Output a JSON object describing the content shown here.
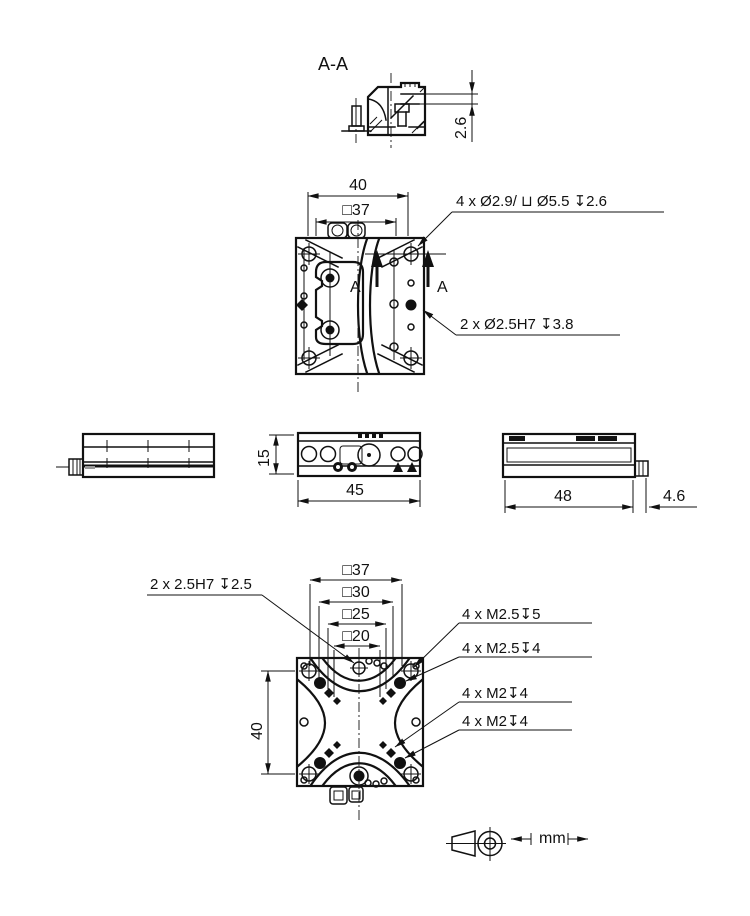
{
  "colors": {
    "ink": "#111111",
    "background": "#ffffff"
  },
  "drawing": {
    "section": {
      "title": "A-A",
      "depth_dim": "2.6"
    },
    "top_view": {
      "width_dim": "40",
      "square_dim": "□37",
      "counterbore_note": "4 x Ø2.9/ ⊔ Ø5.5 ↧2.6",
      "dowel_note": "2 x Ø2.5H7 ↧3.8",
      "cut_label": "A"
    },
    "front_view": {
      "height_dim": "15",
      "width_dim": "45"
    },
    "side_view": {
      "width_dim": "48",
      "connector_dim": "4.6"
    },
    "bottom_view": {
      "square_dims": [
        "□37",
        "□30",
        "□25",
        "□20"
      ],
      "height_dim": "40",
      "dowel_note": "2 x 2.5H7 ↧2.5",
      "thread_notes": [
        "4 x M2.5↧5",
        "4 x M2.5↧4",
        "4 x M2↧4",
        "4 x M2↧4"
      ]
    },
    "units_label": "mm"
  }
}
